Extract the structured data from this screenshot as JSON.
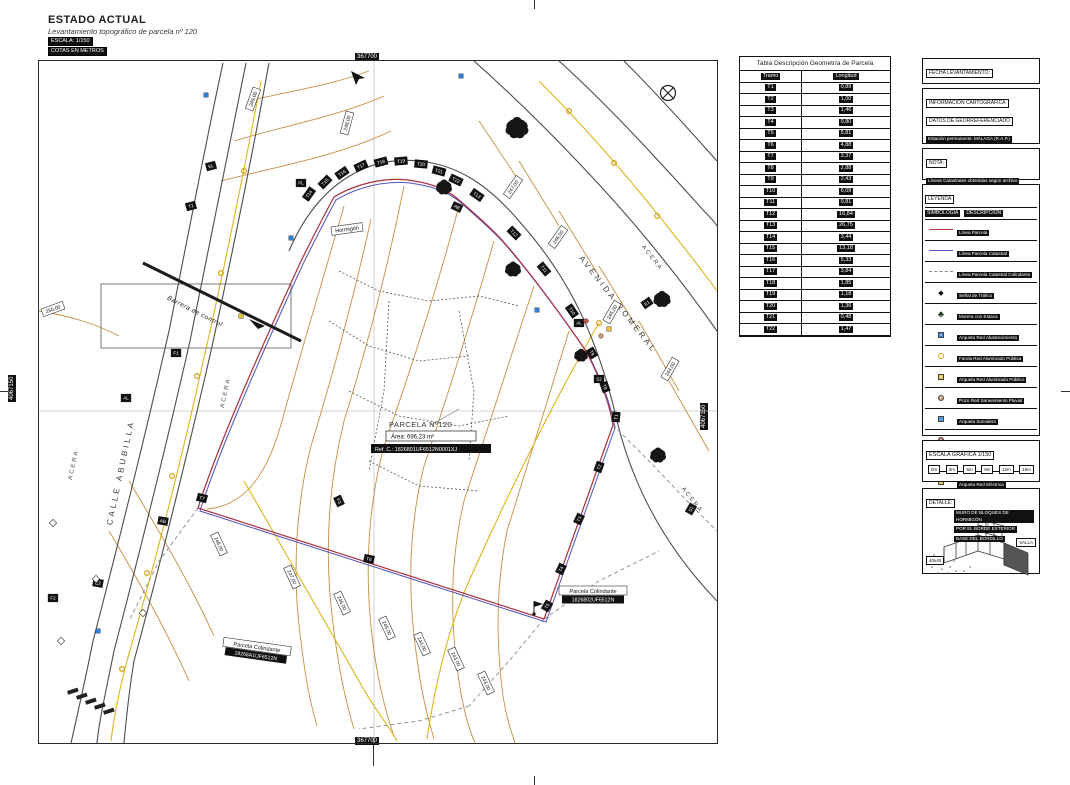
{
  "title": {
    "heading": "ESTADO ACTUAL",
    "subtitle": "Levantamiento topográfico de parcela nº 120",
    "scale_badge": "ESCALA: 1/150",
    "units_badge": "COTAS EN METROS"
  },
  "geometry_table": {
    "title": "Tabla Descripción Geometría de Parcela",
    "columns": [
      "Tramo",
      "Longitud"
    ],
    "rows": [
      [
        "T1",
        "0,89"
      ],
      [
        "T2",
        "1,00"
      ],
      [
        "T3",
        "1,46"
      ],
      [
        "T4",
        "0,80"
      ],
      [
        "T5",
        "5,81"
      ],
      [
        "T6",
        "4,88"
      ],
      [
        "T7",
        "3,37"
      ],
      [
        "T8",
        "2,88"
      ],
      [
        "T9",
        "2,43"
      ],
      [
        "T10",
        "6,09"
      ],
      [
        "T11",
        "0,81"
      ],
      [
        "T12",
        "16,84"
      ],
      [
        "T13",
        "26,75"
      ],
      [
        "T14",
        "3,44"
      ],
      [
        "T15",
        "13,18"
      ],
      [
        "T16",
        "5,33"
      ],
      [
        "T17",
        "3,84"
      ],
      [
        "T18",
        "1,85"
      ],
      [
        "T19",
        "1,18"
      ],
      [
        "T20",
        "1,36"
      ],
      [
        "T21",
        "0,48"
      ],
      [
        "T22",
        "1,47"
      ]
    ]
  },
  "panels": {
    "fecha": {
      "title": "FECHA LEVANTAMIENTO:",
      "value": "1 de JULIO de 2025"
    },
    "info": {
      "title1": "INFORMACIÓN CARTOGRÁFICA",
      "title2": "DATOS DE GEORREFERENCIADO",
      "lines": [
        "Estación permanente: MÁLAGA (R.A.P.)",
        "Metodología: Técnica GPS",
        "Sistema de Referencia: ETRS-89",
        "Proyección Cartográfica: UTM, HUSO 30",
        "Altura ortométrica: Geoide EGM08-REDNAP"
      ]
    },
    "nota": {
      "title": "NOTA:",
      "lines": [
        "Líneas Catastrales obtenidas según archivo",
        "(DXF) de la Sede Electrónica de Catastro"
      ]
    },
    "leyenda": {
      "title": "LEYENDA",
      "col1": "SIMBOLOGÍA",
      "col2": "DESCRIPCIÓN",
      "items": [
        {
          "sym": "line",
          "color": "#b03545",
          "dash": false,
          "label": "Línea Parcela"
        },
        {
          "sym": "line",
          "color": "#5050c0",
          "dash": false,
          "label": "Línea Parcela Catastral"
        },
        {
          "sym": "line",
          "color": "#8a8a8a",
          "dash": true,
          "label": "Línea Parcela Catastral Colindante"
        },
        {
          "sym": "sign",
          "color": "#111111",
          "label": "Señal de Tráfico"
        },
        {
          "sym": "tree",
          "color": "#143314",
          "label": "Morera con Estaca"
        },
        {
          "sym": "sq",
          "color": "#2f7fd6",
          "glyph": "A",
          "label": "Arqueta Red Abastecimiento"
        },
        {
          "sym": "circ",
          "color": "#d4a017",
          "open": true,
          "label": "Farola Red Alumbrado Pública"
        },
        {
          "sym": "sq",
          "color": "#e3c13f",
          "glyph": "A",
          "label": "Arqueta Red Alumbrado Público"
        },
        {
          "sym": "circ",
          "color": "#c89b6a",
          "glyph": "P",
          "label": "Pozo Red Saneamiento Pluvial"
        },
        {
          "sym": "sq",
          "color": "#4f9fe0",
          "glyph": "",
          "label": "Arqueta Sumidero"
        },
        {
          "sym": "circ",
          "color": "#c0504d",
          "glyph": "P",
          "label": "Pozo Red Saneamiento Fecal"
        },
        {
          "sym": "sq",
          "color": "#c0504d",
          "glyph": "S",
          "label": "Arqueta Red Saneamiento Fecal"
        },
        {
          "sym": "sq",
          "color": "#e3c13f",
          "glyph": "E",
          "label": "Arqueta Red Eléctrica"
        },
        {
          "sym": "sq",
          "color": "#9a9a9a",
          "glyph": "T",
          "label": "Arqueta Red Telecomunicaciones"
        },
        {
          "sym": "sq",
          "color": "#ffffff",
          "glyph": "D",
          "label": "Arqueta"
        }
      ]
    },
    "escala": {
      "title": "ESCALA GRÁFICA 1/150",
      "ticks": [
        "0m",
        "3m",
        "6m",
        "9m",
        "12m",
        "15m"
      ]
    },
    "detalle": {
      "title": "DETALLE:",
      "annotation": [
        "MURO DE BLOQUES DE HORMIGÓN",
        "POR EL BORDE EXTERIOR",
        "BASE DEL BORDILLO"
      ],
      "valla": "VALLA",
      "dim": "40x40"
    }
  },
  "map": {
    "grid": {
      "x_label": "367700",
      "y_label": "4067150"
    },
    "parcel": {
      "name": "PARCELA Nº120",
      "area": "Área:  696,23 m²",
      "ref": "Ref. C.: 1826801UF6512N0001XJ"
    },
    "neighbors": [
      {
        "label": "Parcela Colindante",
        "ref": "1826802UF6512N",
        "x": 554,
        "y": 530,
        "r": 0
      },
      {
        "label": "Parcela Colindante",
        "ref": "18268A1UF6512N",
        "x": 218,
        "y": 586,
        "r": 8
      }
    ],
    "street_labels": [
      {
        "t": "CALLE ABUBILLA",
        "x": 84,
        "y": 412,
        "r": -78,
        "cls": "street"
      },
      {
        "t": "AVENIDA ROMERAL",
        "x": 577,
        "y": 245,
        "r": 52,
        "cls": "street"
      },
      {
        "t": "ACERA",
        "x": 188,
        "y": 332,
        "r": -78,
        "cls": "acera"
      },
      {
        "t": "ACERA",
        "x": 36,
        "y": 404,
        "r": -78,
        "cls": "acera"
      },
      {
        "t": "ACERA",
        "x": 612,
        "y": 198,
        "r": 52,
        "cls": "acera"
      },
      {
        "t": "ACERA",
        "x": 652,
        "y": 440,
        "r": 52,
        "cls": "acera"
      },
      {
        "t": "Barrera de control",
        "x": 155,
        "y": 252,
        "r": 27,
        "cls": "small"
      }
    ],
    "surface_label": {
      "t": "Hormigón",
      "x": 308,
      "y": 168,
      "r": -8
    },
    "contour_labels": [
      {
        "t": "250,00",
        "x": 14,
        "y": 248,
        "r": -20
      },
      {
        "t": "249,00",
        "x": 214,
        "y": 38,
        "r": -70
      },
      {
        "t": "248,00",
        "x": 308,
        "y": 62,
        "r": -75
      },
      {
        "t": "247,00",
        "x": 474,
        "y": 126,
        "r": -55
      },
      {
        "t": "246,00",
        "x": 519,
        "y": 176,
        "r": -55
      },
      {
        "t": "245,00",
        "x": 573,
        "y": 251,
        "r": -60
      },
      {
        "t": "244,00",
        "x": 631,
        "y": 308,
        "r": -60
      },
      {
        "t": "248,00",
        "x": 180,
        "y": 483,
        "r": 65
      },
      {
        "t": "247,00",
        "x": 253,
        "y": 516,
        "r": 65
      },
      {
        "t": "246,00",
        "x": 303,
        "y": 542,
        "r": 65
      },
      {
        "t": "245,00",
        "x": 348,
        "y": 567,
        "r": 65
      },
      {
        "t": "244,00",
        "x": 383,
        "y": 583,
        "r": 65
      },
      {
        "t": "243,00",
        "x": 417,
        "y": 598,
        "r": 65
      },
      {
        "t": "243,00",
        "x": 447,
        "y": 622,
        "r": 65
      }
    ],
    "tramo_labels": [
      {
        "t": "T14",
        "x": 270,
        "y": 133,
        "r": -55
      },
      {
        "t": "T15",
        "x": 286,
        "y": 121,
        "r": -45
      },
      {
        "t": "T16",
        "x": 303,
        "y": 112,
        "r": -35
      },
      {
        "t": "T17",
        "x": 322,
        "y": 105,
        "r": -25
      },
      {
        "t": "T18",
        "x": 342,
        "y": 101,
        "r": -15
      },
      {
        "t": "T19",
        "x": 362,
        "y": 100,
        "r": -5
      },
      {
        "t": "T20",
        "x": 382,
        "y": 103,
        "r": 5
      },
      {
        "t": "T21",
        "x": 400,
        "y": 110,
        "r": 15
      },
      {
        "t": "T22",
        "x": 417,
        "y": 119,
        "r": 25
      },
      {
        "t": "T13",
        "x": 438,
        "y": 134,
        "r": 35
      },
      {
        "t": "T12",
        "x": 475,
        "y": 172,
        "r": 45
      },
      {
        "t": "T11",
        "x": 505,
        "y": 208,
        "r": 50
      },
      {
        "t": "T10",
        "x": 533,
        "y": 250,
        "r": 55
      },
      {
        "t": "T9",
        "x": 553,
        "y": 292,
        "r": 60
      },
      {
        "t": "T8",
        "x": 566,
        "y": 326,
        "r": 70
      },
      {
        "t": "T1",
        "x": 577,
        "y": 356,
        "r": -85
      },
      {
        "t": "T2",
        "x": 560,
        "y": 406,
        "r": -70
      },
      {
        "t": "T3",
        "x": 540,
        "y": 458,
        "r": -65
      },
      {
        "t": "T4",
        "x": 522,
        "y": 508,
        "r": -65
      },
      {
        "t": "T5",
        "x": 508,
        "y": 545,
        "r": -60
      },
      {
        "t": "T6",
        "x": 330,
        "y": 498,
        "r": 12
      },
      {
        "t": "T7",
        "x": 163,
        "y": 437,
        "r": 15
      }
    ],
    "code_labels": [
      {
        "t": "EL",
        "x": 172,
        "y": 105,
        "r": -15
      },
      {
        "t": "T1",
        "x": 152,
        "y": 145,
        "r": -15
      },
      {
        "t": "PL",
        "x": 262,
        "y": 122,
        "r": 0
      },
      {
        "t": "F1",
        "x": 137,
        "y": 292,
        "r": 0
      },
      {
        "t": "AL",
        "x": 87,
        "y": 337,
        "r": 0
      },
      {
        "t": "AB",
        "x": 124,
        "y": 460,
        "r": 10
      },
      {
        "t": "E2",
        "x": 59,
        "y": 522,
        "r": 10
      },
      {
        "t": "F2",
        "x": 14,
        "y": 537,
        "r": 0
      },
      {
        "t": "AL",
        "x": 540,
        "y": 262,
        "r": 0
      },
      {
        "t": "S2",
        "x": 560,
        "y": 318,
        "r": 0
      },
      {
        "t": "E1",
        "x": 608,
        "y": 242,
        "r": -35
      },
      {
        "t": "S1",
        "x": 652,
        "y": 448,
        "r": -60
      },
      {
        "t": "AB",
        "x": 418,
        "y": 146,
        "r": 25
      },
      {
        "t": "F3",
        "x": 300,
        "y": 440,
        "r": 65
      }
    ],
    "trees": [
      {
        "x": 478,
        "y": 68,
        "s": 20
      },
      {
        "x": 405,
        "y": 127,
        "s": 14
      },
      {
        "x": 474,
        "y": 209,
        "s": 14
      },
      {
        "x": 623,
        "y": 239,
        "s": 15
      },
      {
        "x": 542,
        "y": 295,
        "s": 12
      },
      {
        "x": 619,
        "y": 395,
        "s": 14
      }
    ],
    "symbols": [
      {
        "k": "sq",
        "c": "#2f7fd6",
        "x": 167,
        "y": 34
      },
      {
        "k": "sq",
        "c": "#2f7fd6",
        "x": 422,
        "y": 15
      },
      {
        "k": "sq",
        "c": "#2f7fd6",
        "x": 498,
        "y": 249
      },
      {
        "k": "sq",
        "c": "#2f7fd6",
        "x": 59,
        "y": 570
      },
      {
        "k": "sq",
        "c": "#2f7fd6",
        "x": 252,
        "y": 177
      },
      {
        "k": "circ",
        "c": "#d4a017",
        "x": 205,
        "y": 110,
        "open": true
      },
      {
        "k": "circ",
        "c": "#d4a017",
        "x": 182,
        "y": 212,
        "open": true
      },
      {
        "k": "circ",
        "c": "#d4a017",
        "x": 158,
        "y": 315,
        "open": true
      },
      {
        "k": "circ",
        "c": "#d4a017",
        "x": 133,
        "y": 415,
        "open": true
      },
      {
        "k": "circ",
        "c": "#d4a017",
        "x": 108,
        "y": 512,
        "open": true
      },
      {
        "k": "circ",
        "c": "#d4a017",
        "x": 83,
        "y": 608,
        "open": true
      },
      {
        "k": "circ",
        "c": "#d4a017",
        "x": 530,
        "y": 50,
        "open": true
      },
      {
        "k": "circ",
        "c": "#d4a017",
        "x": 575,
        "y": 102,
        "open": true
      },
      {
        "k": "circ",
        "c": "#d4a017",
        "x": 618,
        "y": 155,
        "open": true
      },
      {
        "k": "circ",
        "c": "#d4a017",
        "x": 560,
        "y": 262,
        "open": true
      },
      {
        "k": "sq",
        "c": "#e3c13f",
        "x": 570,
        "y": 268
      },
      {
        "k": "sq",
        "c": "#e3c13f",
        "x": 202,
        "y": 255
      },
      {
        "k": "circ",
        "c": "#c89b6a",
        "x": 562,
        "y": 275
      },
      {
        "k": "circ",
        "c": "#c0504d",
        "x": 547,
        "y": 260
      },
      {
        "k": "diam",
        "c": "#ffffff",
        "x": 14,
        "y": 462
      },
      {
        "k": "diam",
        "c": "#ffffff",
        "x": 57,
        "y": 518
      },
      {
        "k": "diam",
        "c": "#ffffff",
        "x": 104,
        "y": 552
      },
      {
        "k": "diam",
        "c": "#ffffff",
        "x": 22,
        "y": 580
      }
    ]
  },
  "colors": {
    "parcel_line": "#a8303f",
    "cadastral_line": "#5252bf",
    "contour": "#c49043",
    "utility_yellow": "#ddb51f",
    "road": "#4d4d4d"
  }
}
